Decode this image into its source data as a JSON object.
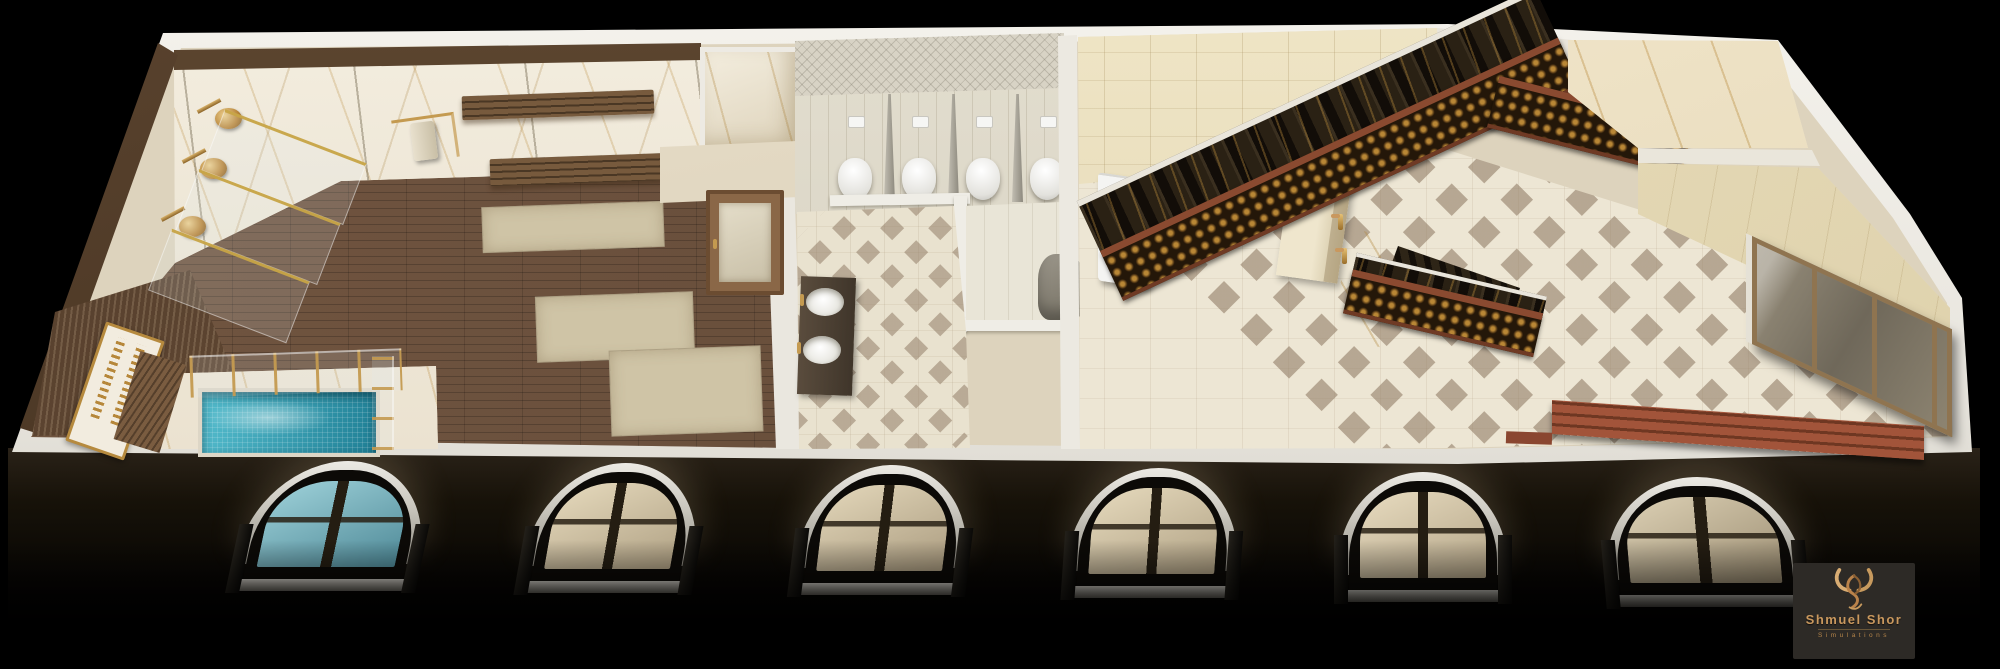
{
  "brand": {
    "logo_title": "Shmuel Shor",
    "logo_subtitle": "Simulations",
    "logo_icon": "bull-horns-icon"
  },
  "palette": {
    "bg": "#000000",
    "wall-white": "#e7e4dc",
    "marble": "#ece4d3",
    "marble-vein": "#bb8f44",
    "wood-floor": "#6b5140",
    "wood-dark": "#4e3a28",
    "rug": "#cfc4a6",
    "pool-water": "#3aa4b8",
    "pool-deep": "#1f7f95",
    "gold": "#c49a50",
    "gold-deep": "#a5752c",
    "tile-cream": "#ede6d4",
    "tile-accent": "#a2927f",
    "tile-beige": "#e7dbbb",
    "wallpaper": "#d8d3c5",
    "toilet-white": "#f3f3f1",
    "partition-gray": "#9a958a",
    "stair-black": "#211a12",
    "handrail-wood": "#8a4a30",
    "landing-marble": "#f0e5cb",
    "glass-door": "#8d8471",
    "bench-red": "#9c4f33",
    "facade-dark": "#16120d",
    "logo-panel": "#2d2a26",
    "logo-gold": "#c9985e"
  },
  "facade": {
    "window_count": 6,
    "windows": [
      {
        "x": 243,
        "w": 182,
        "y": 461,
        "k": "-12deg",
        "t1": "#9fd2da",
        "t2": "#4f8a98"
      },
      {
        "x": 529,
        "w": 170,
        "y": 463,
        "k": "-10deg",
        "t1": "#e6dabd",
        "t2": "#b0a184"
      },
      {
        "x": 799,
        "w": 170,
        "y": 465,
        "k": "-7deg",
        "t1": "#e3d7ba",
        "t2": "#ab9c80"
      },
      {
        "x": 1069,
        "w": 170,
        "y": 468,
        "k": "-4deg",
        "t1": "#e6dabd",
        "t2": "#b0a184"
      },
      {
        "x": 1338,
        "w": 170,
        "y": 472,
        "k": "0deg",
        "t1": "#e8dcc0",
        "t2": "#b3a487"
      },
      {
        "x": 1605,
        "w": 196,
        "y": 477,
        "k": "5deg",
        "t1": "#ddd1b5",
        "t2": "#9b8d72"
      }
    ]
  },
  "bathroom": {
    "toilets": [
      {
        "x": 838
      },
      {
        "x": 902
      },
      {
        "x": 966
      },
      {
        "x": 1030
      }
    ],
    "partitions": [
      {
        "x": 884
      },
      {
        "x": 948
      },
      {
        "x": 1012
      }
    ]
  },
  "mikveh_room": {
    "showers": [
      {
        "x": 196,
        "y": 98
      },
      {
        "x": 181,
        "y": 148
      },
      {
        "x": 160,
        "y": 206
      }
    ]
  },
  "hall": {
    "wash_faucets": [
      {
        "x": 1330,
        "y": 146
      },
      {
        "x": 1334,
        "y": 180
      },
      {
        "x": 1338,
        "y": 214
      },
      {
        "x": 1342,
        "y": 248
      }
    ]
  }
}
